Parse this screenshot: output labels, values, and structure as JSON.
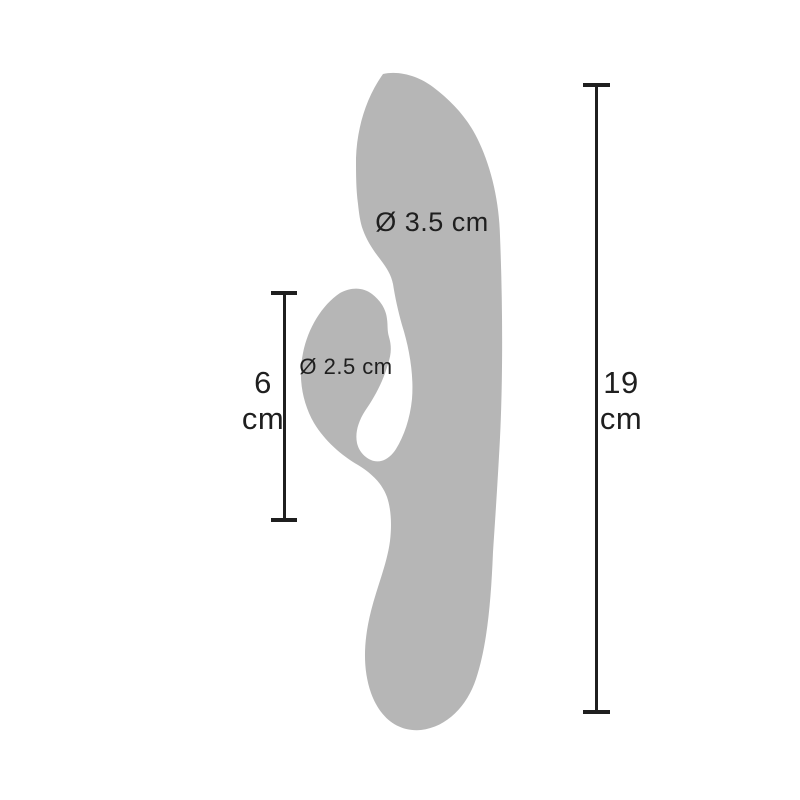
{
  "colors": {
    "silhouette": "#b6b6b6",
    "lines_and_text": "#1f1f1f",
    "background": "#ffffff"
  },
  "annotations": {
    "shaft_diameter_label": "Ø 3.5 cm",
    "arm_diameter_label": "Ø 2.5 cm"
  },
  "measurements": {
    "left": {
      "value": "6",
      "unit": "cm"
    },
    "right": {
      "value": "19",
      "unit": "cm"
    }
  }
}
